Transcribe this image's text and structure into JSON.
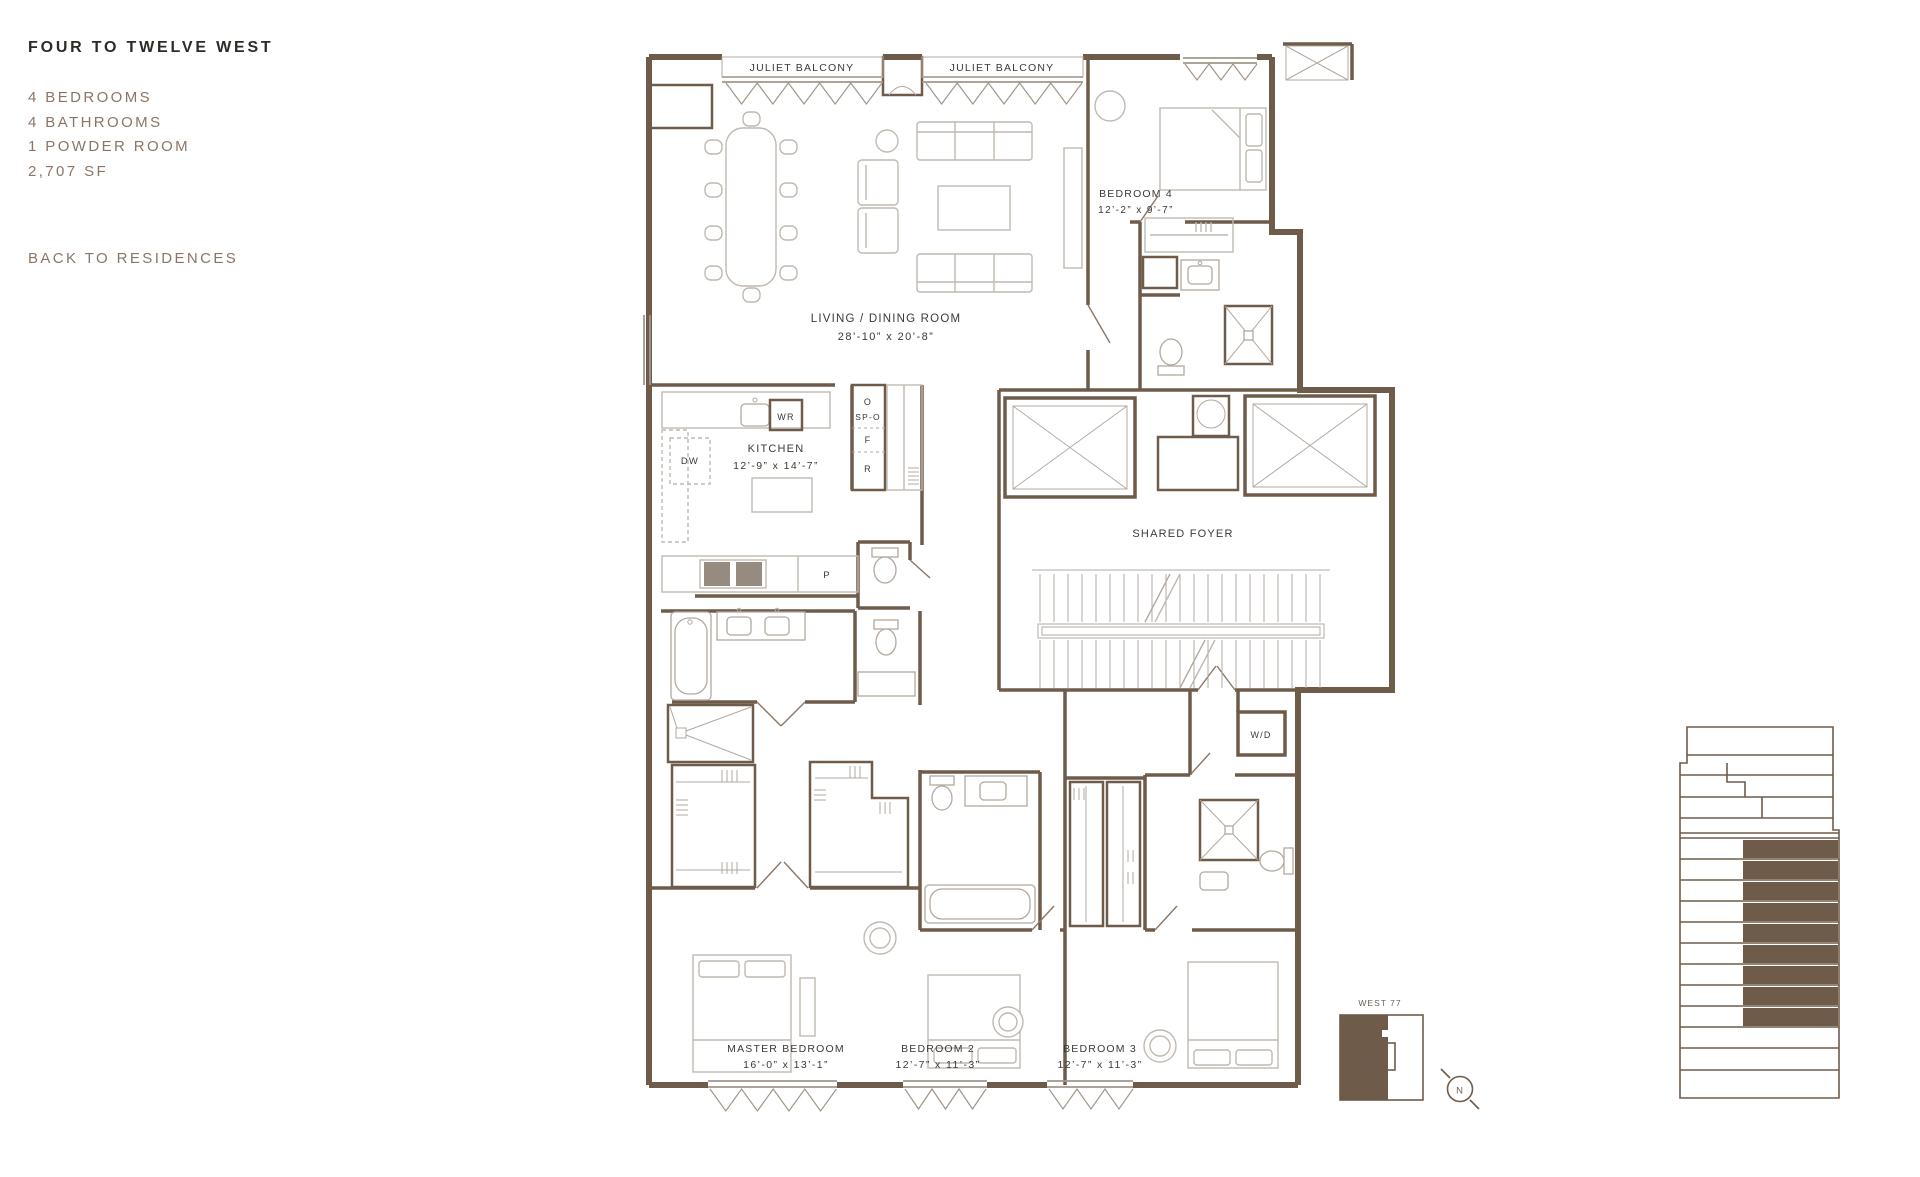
{
  "page": {
    "title": "FOUR TO TWELVE WEST",
    "specs": [
      "4 BEDROOMS",
      "4 BATHROOMS",
      "1 POWDER ROOM",
      "2,707 SF"
    ],
    "back_link": "BACK TO RESIDENCES"
  },
  "floorplan": {
    "juliet_balcony_left": "JULIET BALCONY",
    "juliet_balcony_right": "JULIET BALCONY",
    "living_dining": {
      "name": "LIVING / DINING ROOM",
      "dims": "28’-10” x 20’-8”"
    },
    "kitchen": {
      "name": "KITCHEN",
      "dims": "12’-9” x 14’-7”"
    },
    "bedroom_4": {
      "name": "BEDROOM 4",
      "dims": "12’-2” x 9’-7”"
    },
    "master_bedroom": {
      "name": "MASTER BEDROOM",
      "dims": "16’-0” x 13’-1”"
    },
    "bedroom_2": {
      "name": "BEDROOM 2",
      "dims": "12’-7” x 11’-3”"
    },
    "bedroom_3": {
      "name": "BEDROOM 3",
      "dims": "12’-7” x 11’-3”"
    },
    "shared_foyer": "SHARED FOYER",
    "labels": {
      "wr": "WR",
      "dw": "DW",
      "oven": "O",
      "speed_oven": "SP-O",
      "freezer": "F",
      "refrigerator": "R",
      "pantry": "P",
      "washer_dryer": "W/D"
    }
  },
  "keyplan": {
    "label": "WEST 77",
    "compass": "N"
  },
  "elevation_key": {
    "floors_total": 16,
    "floors_highlighted": 9
  },
  "colors": {
    "wall": "#6F5B4A",
    "accent_brown": "#8C7567",
    "furniture": "#C1B9B1",
    "label": "#3C3936"
  }
}
